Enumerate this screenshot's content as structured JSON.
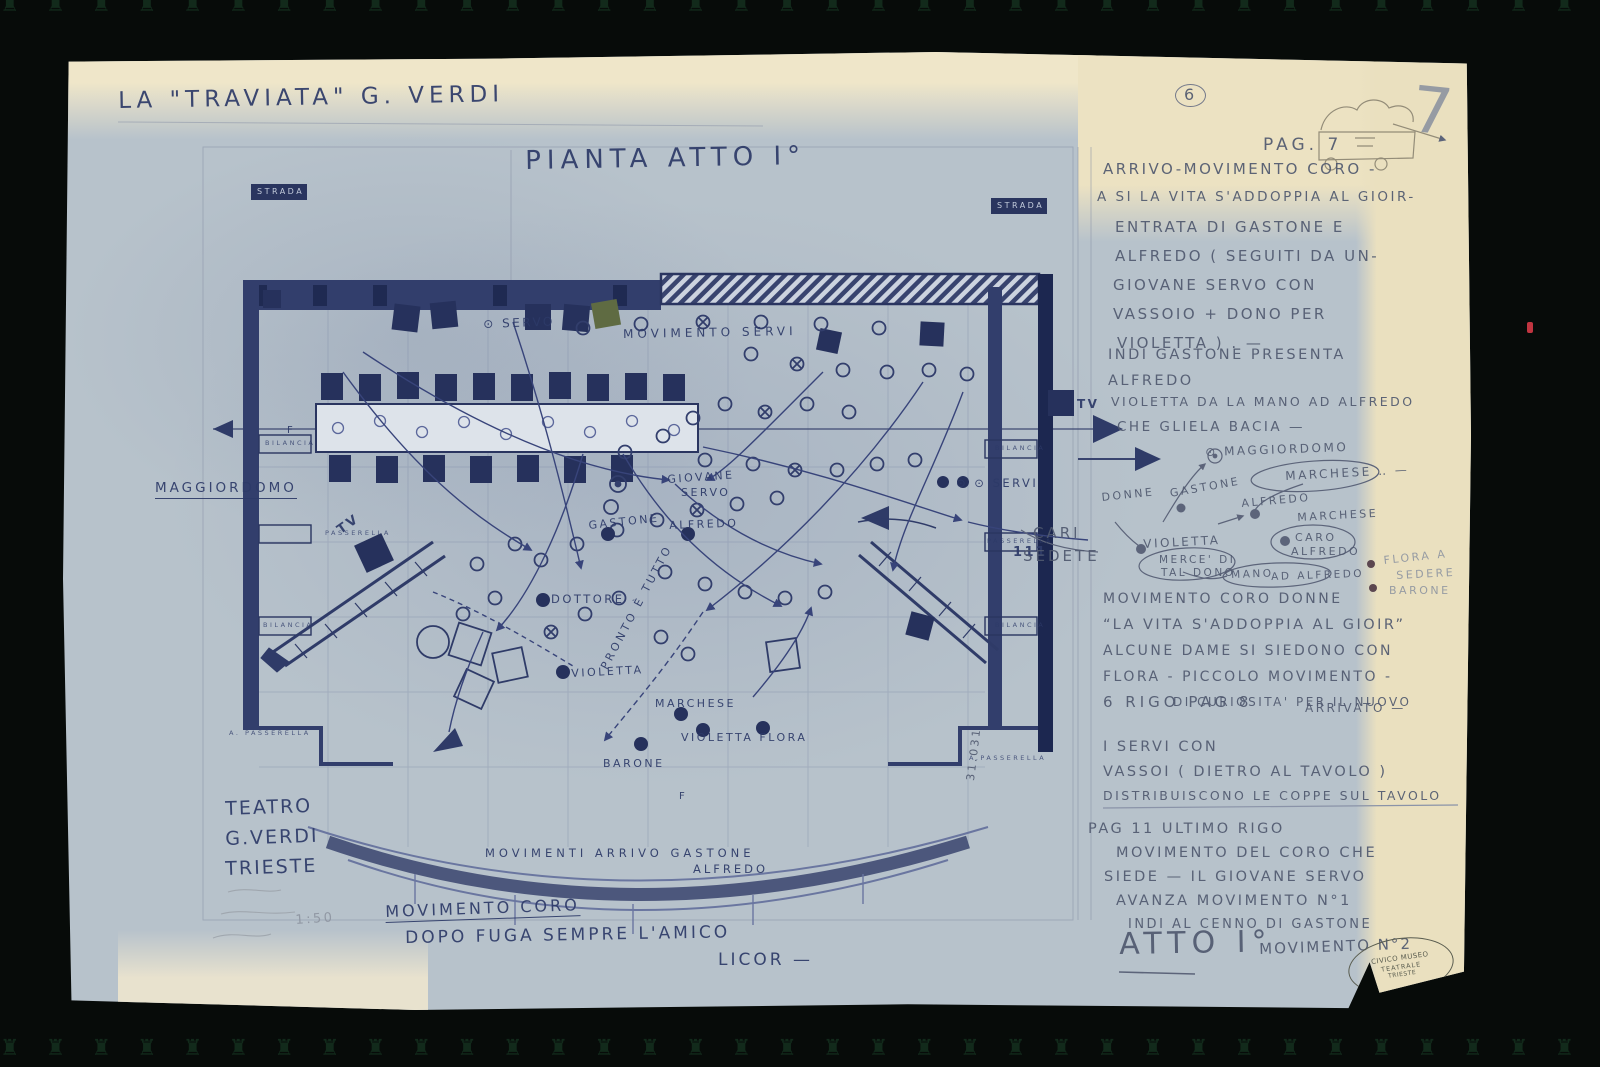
{
  "document": {
    "kind": "Scanned theatrical staging blueprint",
    "stamp": {
      "line1": "CIVICO MUSEO",
      "line2": "TEATRALE",
      "line3": "TRIESTE"
    }
  },
  "colors": {
    "paper_blue": "#b7c2cb",
    "paper_cream": "#eae0bf",
    "ink_blue": "#2d3a68",
    "pencil_grey": "#50596f",
    "wall_dark": "#26315c",
    "background": "#070b09"
  },
  "notes": {
    "blocks": [
      {
        "x": 1040,
        "y": 110,
        "lh": 29,
        "s": 15,
        "lines": [
          "ARRIVO-MOVIMENTO CORO -",
          {
            "t": "A SI LA VITA S'ADDOPPIA AL GIOIR-",
            "dx": -6,
            "s": 13.5
          },
          {
            "t": "ENTRATA DI GASTONE E",
            "dx": 12
          },
          {
            "t": "ALFREDO ( SEGUITI DA UN-",
            "dx": 12
          },
          {
            "t": "GIOVANE SERVO CON",
            "dx": 10
          },
          {
            "t": "VASSOIO + DONO PER",
            "dx": 10
          },
          {
            "t": "VIOLETTA ) . —",
            "dx": 14
          }
        ]
      },
      {
        "x": 1045,
        "y": 296,
        "lh": 26,
        "s": 14.5,
        "lines": [
          "INDI GASTONE PRESENTA",
          "ALFREDO"
        ]
      },
      {
        "x": 1048,
        "y": 344,
        "lh": 25,
        "s": 12.5,
        "lines": [
          "VIOLETTA DA LA MANO AD ALFREDO",
          {
            "t": "CHE GLIELA BACIA —",
            "s": 13.5,
            "dx": 6
          }
        ]
      },
      {
        "x": 1040,
        "y": 540,
        "lh": 26,
        "s": 14,
        "lines": [
          "MOVIMENTO CORO DONNE",
          {
            "t": "“LA VITA S'ADDOPPIA AL GIOIR”",
            "s": 14.5
          },
          "ALCUNE DAME SI SIEDONO CON",
          "FLORA - PICCOLO MOVIMENTO -",
          {
            "t": "DI CURIOSITA' PER IL NUOVO",
            "dx": 70,
            "s": 12
          }
        ]
      },
      {
        "x": 1040,
        "y": 688,
        "lh": 25,
        "s": 14.5,
        "lines": [
          "I SERVI CON",
          "VASSOI ( DIETRO AL TAVOLO )",
          {
            "t": "DISTRIBUISCONO LE COPPE SUL TAVOLO",
            "s": 12.5
          }
        ]
      },
      {
        "x": 1025,
        "y": 770,
        "lh": 24,
        "s": 14.5,
        "lines": [
          "PAG 11 ULTIMO RIGO",
          {
            "t": "MOVIMENTO DEL CORO CHE",
            "dx": 28
          },
          {
            "t": "SIEDE — IL GIOVANE SERVO",
            "dx": 16
          },
          {
            "t": "AVANZA MOVIMENTO N°1",
            "dx": 28
          },
          {
            "t": "INDI AL CENNO DI GASTONE",
            "dx": 40,
            "s": 13
          }
        ]
      }
    ]
  },
  "plan": {
    "labels": [
      {
        "n": "document-title",
        "t": "LA \"TRAVIATA\"   G. VERDI",
        "x": 55,
        "y": 38,
        "s": 23,
        "r": -1,
        "ls": 5
      },
      {
        "n": "plan-title",
        "t": "PIANTA   ATTO I°",
        "x": 462,
        "y": 96,
        "s": 26,
        "r": -1,
        "ls": 6
      },
      {
        "n": "strada-left",
        "t": "STRADA",
        "x": 194,
        "y": 136,
        "s": 8,
        "c": "box-label"
      },
      {
        "n": "strada-right",
        "t": "STRADA",
        "x": 934,
        "y": 150,
        "s": 8,
        "c": "box-label"
      },
      {
        "t": "⊙ SERVO",
        "x": 420,
        "y": 266,
        "s": 12,
        "r": -2
      },
      {
        "t": "MOVIMENTO  SERVI",
        "x": 560,
        "y": 276,
        "s": 12,
        "ls": 4,
        "r": -1
      },
      {
        "n": "label-maggiordomo",
        "t": "MAGGIORDOMO",
        "x": 92,
        "y": 430,
        "s": 13.5,
        "u": 1,
        "ls": 3
      },
      {
        "t": "TV",
        "x": 272,
        "y": 474,
        "s": 13,
        "r": -35,
        "b": 1
      },
      {
        "t": "GIOVANE",
        "x": 604,
        "y": 422,
        "s": 11,
        "r": -4
      },
      {
        "t": "SERVO",
        "x": 618,
        "y": 435,
        "s": 11
      },
      {
        "t": "GASTONE",
        "x": 525,
        "y": 468,
        "s": 11,
        "r": -6
      },
      {
        "t": "ALFREDO",
        "x": 606,
        "y": 468,
        "s": 11,
        "r": -2
      },
      {
        "t": "DOTTORE",
        "x": 488,
        "y": 542,
        "s": 11.5
      },
      {
        "t": "PRONTO È TUTTO",
        "x": 536,
        "y": 614,
        "s": 11,
        "r": -62,
        "ls": 3
      },
      {
        "t": "VIOLETTA",
        "x": 508,
        "y": 616,
        "s": 11,
        "r": -3
      },
      {
        "t": "MARCHESE",
        "x": 592,
        "y": 646,
        "s": 11
      },
      {
        "t": "VIOLETTA  FLORA",
        "x": 618,
        "y": 680,
        "s": 11
      },
      {
        "t": "BARONE",
        "x": 540,
        "y": 706,
        "s": 11
      },
      {
        "t": "F",
        "x": 616,
        "y": 740,
        "s": 10
      },
      {
        "t": "F",
        "x": 224,
        "y": 374,
        "s": 10
      },
      {
        "t": "⊙ ⊙ SERVI",
        "x": 893,
        "y": 426,
        "s": 11.5
      },
      {
        "t": "TV",
        "x": 1014,
        "y": 346,
        "s": 12,
        "b": 1
      },
      {
        "t": "BILANCIA",
        "x": 202,
        "y": 388,
        "s": 6.5,
        "c": "wall-small"
      },
      {
        "t": "PASSERELLA",
        "x": 262,
        "y": 478,
        "s": 6.5,
        "c": "wall-small"
      },
      {
        "t": "BILANCIA",
        "x": 200,
        "y": 570,
        "s": 6.5,
        "c": "wall-small"
      },
      {
        "t": "A. PASSERELLA",
        "x": 166,
        "y": 678,
        "s": 6.5,
        "c": "wall-small"
      },
      {
        "t": "BILANCIA",
        "x": 932,
        "y": 393,
        "s": 6.5,
        "c": "wall-small"
      },
      {
        "t": "PASSERELLA",
        "x": 924,
        "y": 486,
        "s": 6.5,
        "c": "wall-small"
      },
      {
        "t": "BILANCIA",
        "x": 932,
        "y": 570,
        "s": 6.5,
        "c": "wall-small"
      },
      {
        "t": "A.PASSERELLA",
        "x": 906,
        "y": 703,
        "s": 6.5,
        "c": "wall-small"
      },
      {
        "t": "MOVIMENTI  ARRIVO  GASTONE",
        "x": 422,
        "y": 796,
        "s": 11.5,
        "ls": 4
      },
      {
        "t": "ALFREDO",
        "x": 630,
        "y": 812,
        "s": 11.5,
        "ls": 3
      },
      {
        "n": "label-movimento-coro",
        "t": "MOVIMENTO CORO",
        "x": 322,
        "y": 852,
        "s": 16,
        "r": -2,
        "u": 1,
        "ls": 3
      },
      {
        "t": "DOPO  FUGA  SEMPRE  L'AMICO",
        "x": 342,
        "y": 878,
        "s": 17,
        "r": -1,
        "ls": 3
      },
      {
        "t": "LICOR —",
        "x": 655,
        "y": 900,
        "s": 17,
        "ls": 3
      },
      {
        "n": "theater-name-1",
        "t": "TEATRO",
        "x": 162,
        "y": 748,
        "s": 19,
        "r": -2,
        "ls": 2
      },
      {
        "n": "theater-name-2",
        "t": "G.VERDI",
        "x": 162,
        "y": 778,
        "s": 19,
        "r": -2,
        "ls": 2
      },
      {
        "n": "theater-name-3",
        "t": "TRIESTE",
        "x": 162,
        "y": 808,
        "s": 19,
        "r": -2,
        "ls": 2
      },
      {
        "n": "scale-note",
        "t": "1:50",
        "x": 232,
        "y": 862,
        "s": 13,
        "c": "pencil-faint",
        "r": -4
      },
      {
        "n": "tally-marks",
        "t": "111",
        "x": 950,
        "y": 494,
        "s": 13,
        "b": 1
      },
      {
        "n": "ref-number",
        "t": "31.031",
        "x": 902,
        "y": 728,
        "s": 11,
        "r": -83,
        "c": "pencil"
      },
      {
        "n": "page-badge",
        "t": "6",
        "x": 1112,
        "y": 32,
        "s": 16,
        "c": "pencil",
        "circ": 1
      },
      {
        "n": "corner-number",
        "t": "7",
        "x": 1352,
        "y": 26,
        "s": 64,
        "c": "pencil-faint",
        "r": 6
      },
      {
        "n": "page-header",
        "t": "PAG. 7",
        "x": 1200,
        "y": 85,
        "s": 17,
        "c": "pencil",
        "ls": 4
      },
      {
        "t": "⊙ MAGGIORDOMO",
        "x": 1142,
        "y": 394,
        "s": 12,
        "c": "pencil",
        "r": -2
      },
      {
        "t": "MARCHESE ‥ —",
        "x": 1222,
        "y": 418,
        "s": 12,
        "c": "pencil",
        "r": -3
      },
      {
        "t": "DONNE",
        "x": 1038,
        "y": 440,
        "s": 11,
        "c": "pencil",
        "r": -6
      },
      {
        "t": "GASTONE",
        "x": 1106,
        "y": 436,
        "s": 11,
        "c": "pencil",
        "r": -10
      },
      {
        "t": "ALFREDO",
        "x": 1178,
        "y": 446,
        "s": 11,
        "c": "pencil",
        "r": -5
      },
      {
        "t": "MARCHESE",
        "x": 1234,
        "y": 460,
        "s": 11,
        "c": "pencil",
        "r": -3
      },
      {
        "t": "CARI",
        "x": 970,
        "y": 474,
        "s": 15,
        "c": "pencil",
        "ls": 3
      },
      {
        "t": "SEDETE",
        "x": 960,
        "y": 497,
        "s": 15,
        "c": "pencil",
        "ls": 3
      },
      {
        "t": "VIOLETTA",
        "x": 1080,
        "y": 486,
        "s": 12,
        "c": "pencil",
        "r": -3
      },
      {
        "t": "CARO",
        "x": 1232,
        "y": 480,
        "s": 11,
        "c": "pencil"
      },
      {
        "t": "ALFREDO",
        "x": 1228,
        "y": 494,
        "s": 11,
        "c": "pencil"
      },
      {
        "t": "MERCE' DI",
        "x": 1096,
        "y": 503,
        "s": 10.5,
        "c": "pencil"
      },
      {
        "t": "TAL DONO",
        "x": 1098,
        "y": 516,
        "s": 10.5,
        "c": "pencil"
      },
      {
        "t": "MANO",
        "x": 1168,
        "y": 518,
        "s": 10.5,
        "c": "pencil",
        "r": -2
      },
      {
        "t": "AD ALFREDO",
        "x": 1208,
        "y": 520,
        "s": 10.5,
        "c": "pencil",
        "r": -2
      },
      {
        "t": "FLORA A",
        "x": 1320,
        "y": 503,
        "s": 11,
        "c": "pencil-faint",
        "r": -6
      },
      {
        "t": "SEDERE",
        "x": 1333,
        "y": 518,
        "s": 11,
        "c": "pencil-faint",
        "r": -3
      },
      {
        "t": "BARONE",
        "x": 1326,
        "y": 533,
        "s": 11,
        "c": "pencil-faint"
      },
      {
        "t": "6 RIGO PAG 8",
        "x": 1040,
        "y": 643,
        "s": 15,
        "c": "pencil",
        "ls": 4
      },
      {
        "t": "ARRIVATO —",
        "x": 1242,
        "y": 650,
        "s": 12,
        "c": "pencil"
      },
      {
        "n": "finale-act",
        "t": "ATTO I°",
        "x": 1056,
        "y": 878,
        "s": 30,
        "c": "pencil",
        "ls": 6,
        "r": -1
      },
      {
        "t": "MOVIMENTO N°2",
        "x": 1196,
        "y": 890,
        "s": 15,
        "c": "pencil",
        "r": -2,
        "ls": 2
      }
    ]
  }
}
